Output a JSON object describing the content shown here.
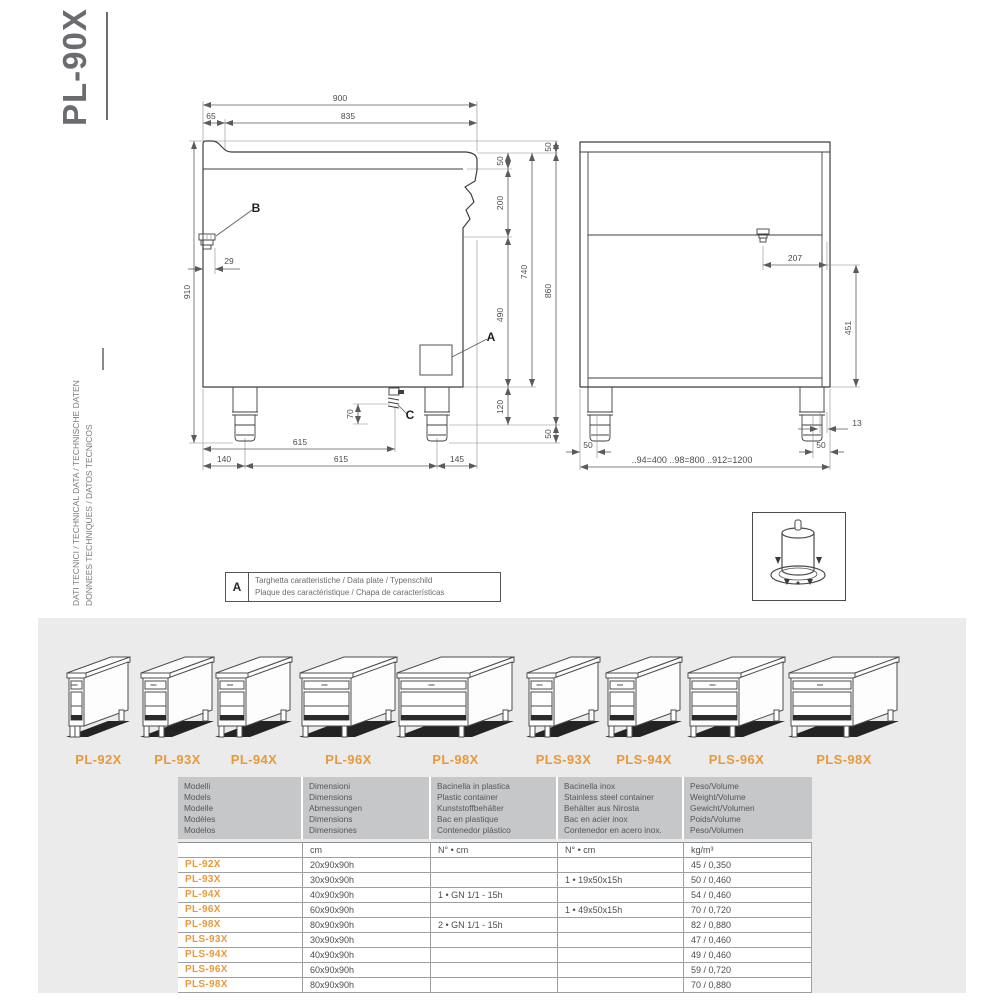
{
  "page": {
    "title": "PL-90X",
    "sidebar_line1": "DATI TECNICI / TECHNICAL DATA / TECHNISCHE DATEN",
    "sidebar_line2": "DONNEES TECHNIQUES / DATOS TECNICOS"
  },
  "drawing": {
    "front": {
      "d900": "900",
      "d65": "65",
      "d835": "835",
      "d910": "910",
      "d29": "29",
      "d50a": "50",
      "d200": "200",
      "d490": "490",
      "d120": "120",
      "d740": "740",
      "d50top": "50",
      "d860": "860",
      "d50bot": "50",
      "d70": "70",
      "d615a": "615",
      "d140": "140",
      "d615b": "615",
      "d145": "145",
      "la": "A",
      "lb": "B",
      "lc": "C"
    },
    "side": {
      "d207": "207",
      "d451": "451",
      "d13": "13",
      "d50l": "50",
      "d50r": "50",
      "note": "..94=400  ..98=800  ..912=1200"
    },
    "legend": {
      "key": "A",
      "line1": "Targhetta caratteristiche / Data plate / Typenschild",
      "line2": "Plaque des caractéristique / Chapa de características"
    }
  },
  "thumbnails": [
    {
      "label": "PL-92X"
    },
    {
      "label": "PL-93X"
    },
    {
      "label": "PL-94X"
    },
    {
      "label": "PL-96X"
    },
    {
      "label": "PL-98X"
    },
    {
      "label": "PLS-93X"
    },
    {
      "label": "PLS-94X"
    },
    {
      "label": "PLS-96X"
    },
    {
      "label": "PLS-98X"
    }
  ],
  "table": {
    "headers": [
      [
        "Modelli",
        "Models",
        "Modelle",
        "Modèles",
        "Modelos"
      ],
      [
        "Dimensioni",
        "Dimensions",
        "Abmessungen",
        "Dimensions",
        "Dimensiones"
      ],
      [
        "Bacinella in plastica",
        "Plastic container",
        "Kunststoffbehälter",
        "Bac en plastique",
        "Contenedor plástico"
      ],
      [
        "Bacinella inox",
        "Stainless steel container",
        "Behälter aus Nirosta",
        "Bac en acier inox",
        "Contenedor en acero inox."
      ],
      [
        "Peso/Volume",
        "Weight/Volume",
        "Gewicht/Volumen",
        "Poids/Volume",
        "Peso/Volumen"
      ]
    ],
    "units": [
      "",
      "cm",
      "N° • cm",
      "N° • cm",
      "kg/m³"
    ],
    "rows": [
      [
        "PL-92X",
        "20x90x90h",
        "",
        "",
        "45 / 0,350"
      ],
      [
        "PL-93X",
        "30x90x90h",
        "",
        "1 • 19x50x15h",
        "50 / 0,460"
      ],
      [
        "PL-94X",
        "40x90x90h",
        "1 • GN 1/1 - 15h",
        "",
        "54 / 0,460"
      ],
      [
        "PL-96X",
        "60x90x90h",
        "",
        "1 • 49x50x15h",
        "70 / 0,720"
      ],
      [
        "PL-98X",
        "80x90x90h",
        "2 • GN 1/1 - 15h",
        "",
        "82 / 0,880"
      ],
      [
        "PLS-93X",
        "30x90x90h",
        "",
        "",
        "47 / 0,460"
      ],
      [
        "PLS-94X",
        "40x90x90h",
        "",
        "",
        "49 / 0,460"
      ],
      [
        "PLS-96X",
        "60x90x90h",
        "",
        "",
        "59 / 0,720"
      ],
      [
        "PLS-98X",
        "80x90x90h",
        "",
        "",
        "70 / 0,880"
      ]
    ]
  },
  "colors": {
    "accent": "#e8993b",
    "panel": "#ebebec",
    "table_header": "#c6c7c9",
    "line": "#3e3f41"
  }
}
